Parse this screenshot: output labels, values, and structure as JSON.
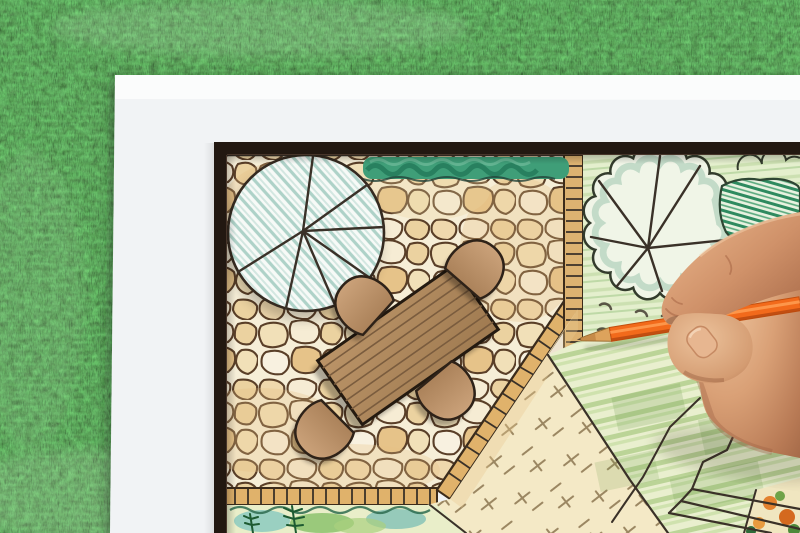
{
  "scene": {
    "type": "photograph",
    "description": "A right hand holding an orange colored pencil draws a garden landscape-architecture plan on a white sheet with a dark frame border, lying on green artificial grass",
    "setting": "white plan sheet over artificial grass lawn",
    "drawing_subject": "garden design plan",
    "plan_elements": [
      "flagstone patio",
      "green hedge strip",
      "large round tree symbol with radial branches",
      "wooden plank dining table",
      "four rounded patio chairs",
      "stepping-stone ladder path",
      "scalloped tree symbols",
      "dark hatched shrub",
      "striped lawn area",
      "gravel area with tick marks",
      "brick edging borders",
      "planting bed with ferns",
      "corner flower bed",
      "sketched zigzag bed outline"
    ],
    "action": "hand coloring the lawn area with an orange pencil"
  },
  "palette": {
    "grass_base": "#4f8a44",
    "grass_dark": "#2f5e2c",
    "grass_light": "#8fbb67",
    "paper": "#f9fafb",
    "frame": "#221811",
    "patio_cream": "#f6eed7",
    "stone_outline": "#5a3f28",
    "brick": "#e0b26b",
    "hedge_green": "#3f9e78",
    "tree_hatch": "#aed2c8",
    "garden_green": "#e4efcd",
    "lawn_stripe": "#a3c779",
    "sand": "#f4e9c6",
    "sand_mark": "#8c7550",
    "table_wood": "#b79069",
    "chair_wood": "#c59d70",
    "ink": "#3a3128",
    "pencil_orange": "#f26a1b",
    "pencil_wood": "#dda35c",
    "pencil_graphite": "#50402e",
    "skin_mid": "#cf9169",
    "skin_light": "#efc9a3",
    "skin_shadow": "#9b5c40",
    "nail": "#e7b690"
  }
}
